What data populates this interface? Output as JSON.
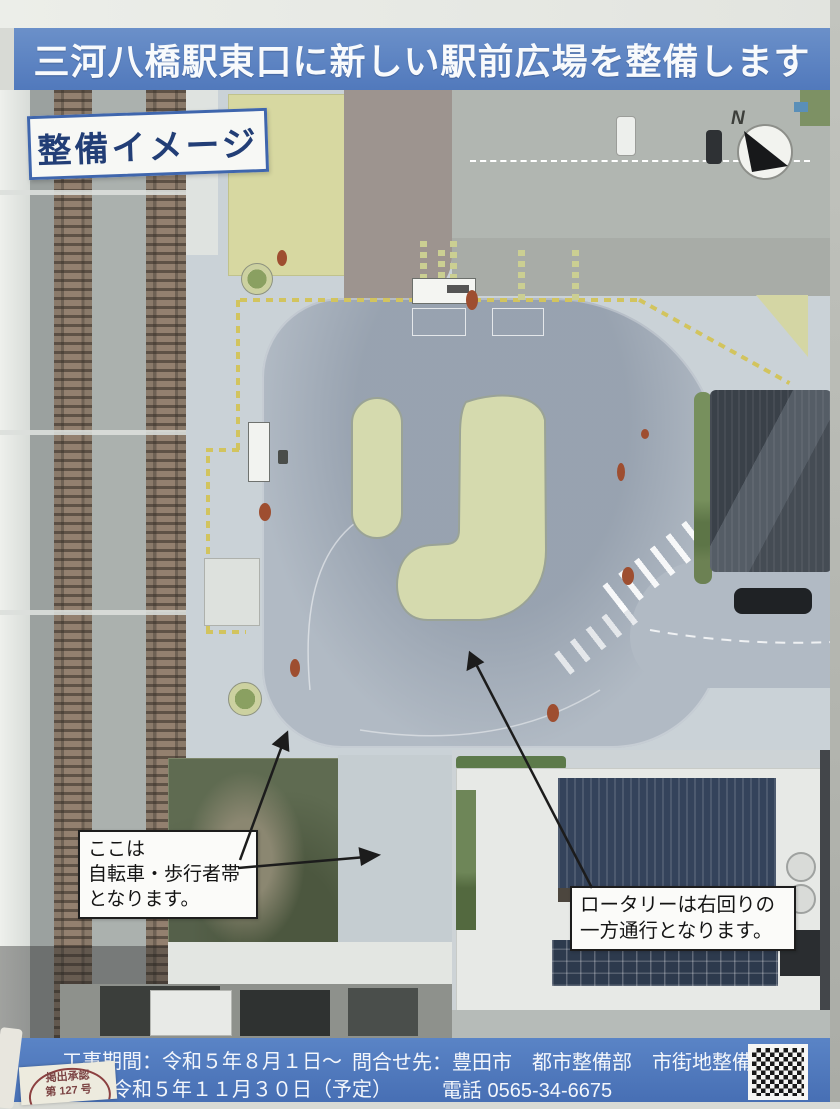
{
  "header": {
    "title": "三河八橋駅東口に新しい駅前広場を整備します"
  },
  "map": {
    "label": "整備イメージ",
    "compass_n": "N",
    "callout_bike_ped": {
      "line1": "ここは",
      "line2": "自転車・歩行者帯",
      "line3": "となります。"
    },
    "callout_rotary": {
      "line1": "ロータリーは右回りの",
      "line2": "一方通行となります。"
    }
  },
  "footer": {
    "period_line1": "工事期間：令和５年８月１日～",
    "period_line2": "令和５年１１月３０日（予定）",
    "contact_line1": "問合せ先：豊田市　都市整備部　市街地整備課",
    "contact_line2": "電話 0565-34-6675"
  },
  "stamp": {
    "line1": "掲出承認",
    "line2": "第 127 号"
  },
  "colors": {
    "banner_blue": "#5179bc",
    "plaza_gray": "#cad2d7",
    "roadway_gray": "#b1bac4",
    "island_green": "#d5daae",
    "vacant_lot_green": "#5f6b51",
    "factory_roof_navy": "#34435b",
    "tactile_yellow": "#d2c45e",
    "callout_border": "#1d1d1d"
  }
}
